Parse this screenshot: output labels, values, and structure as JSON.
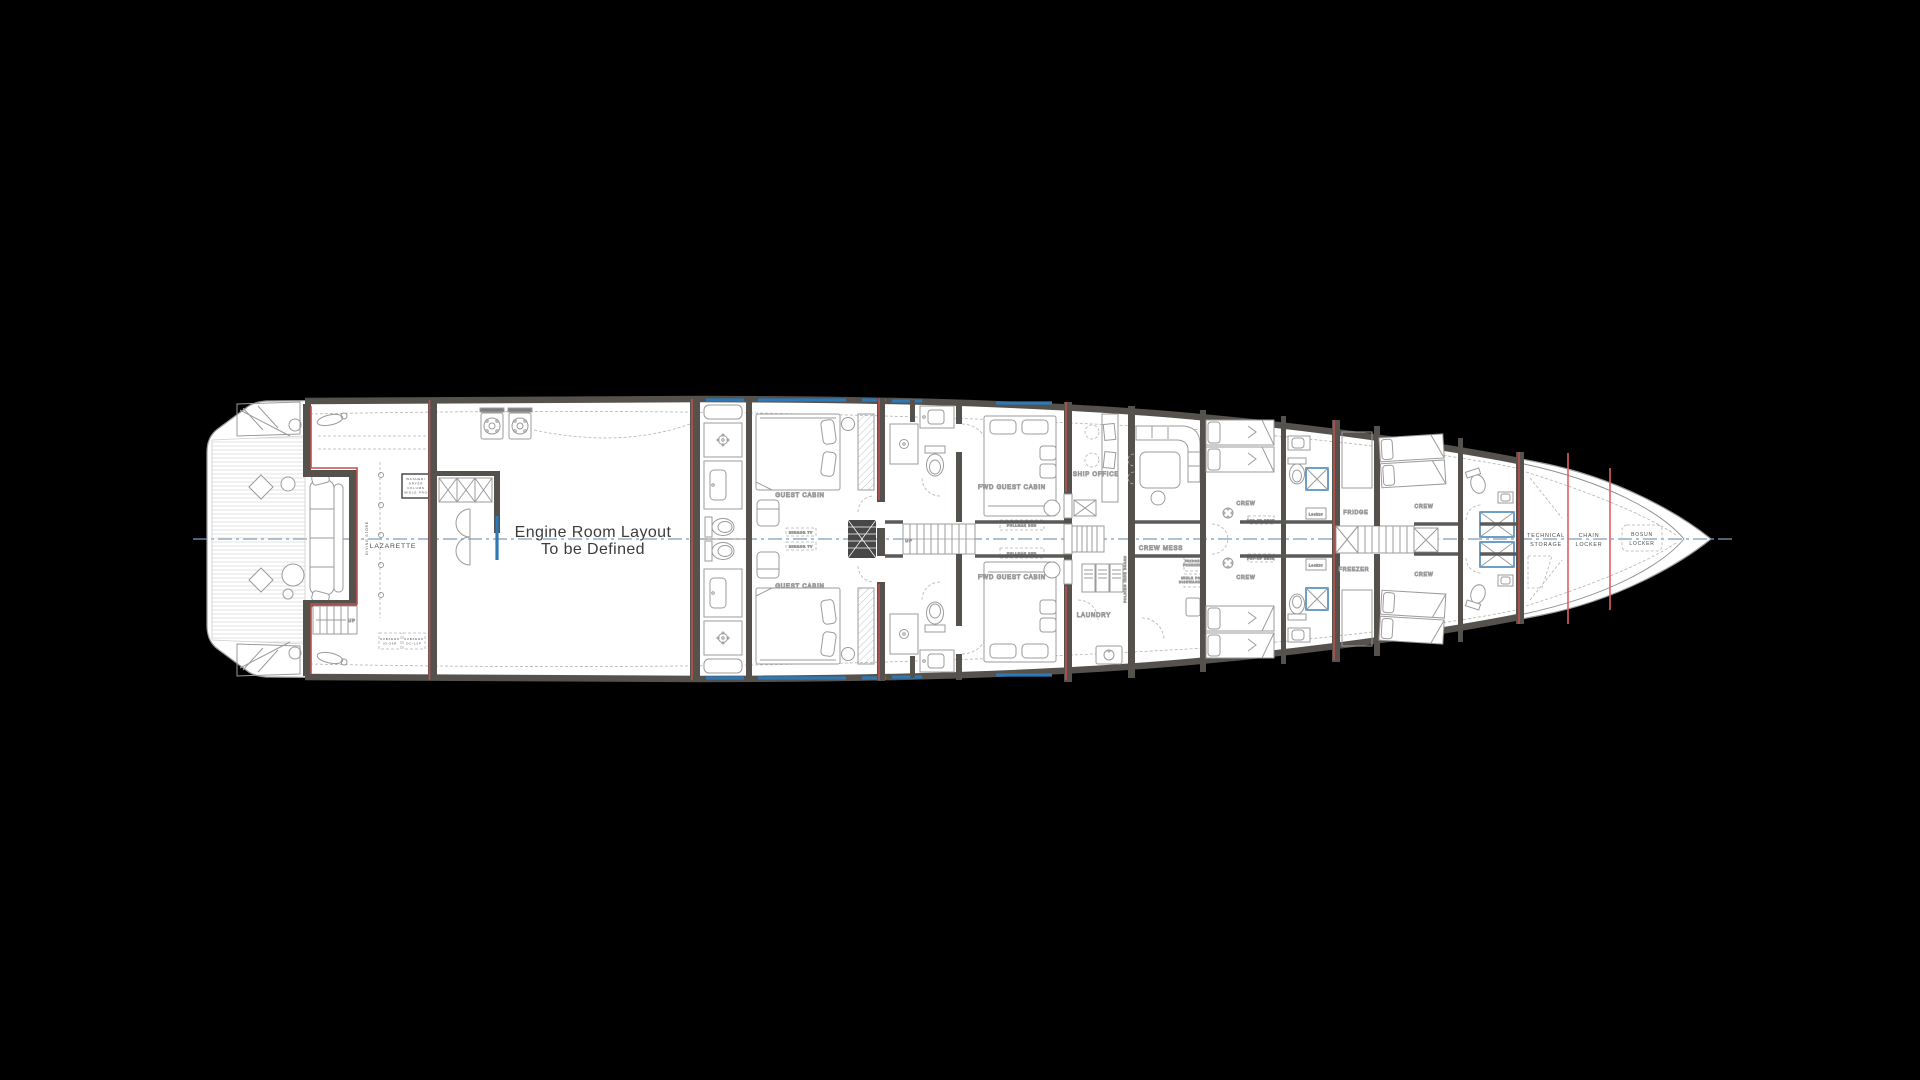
{
  "colors": {
    "background": "#000000",
    "hull_fill": "#ffffff",
    "wall": "#55514d",
    "furniture_line": "#9b9b9b",
    "text": "#4a4a4a",
    "red_accent": "#c0504d",
    "red_frame": "#e06060",
    "blue_accent": "#2e78b5",
    "centerline": "#7f9db9",
    "dash_line": "#b3b3b3"
  },
  "rooms": {
    "lazarette": "LAZARETTE",
    "diving_store": "DIVING STORE",
    "engine_room": {
      "line1": "Engine Room Layout",
      "line2": "To be Defined"
    },
    "guest_cabin": "GUEST CABIN",
    "fwd_guest_cabin": "FWD GUEST CABIN",
    "ship_office": "SHIP OFFICE",
    "laundry": "LAUNDRY",
    "crew_mess": "CREW MESS",
    "crew": "CREW",
    "fridge": "FRIDGE",
    "freezer": "FREEZER",
    "technical_storage": {
      "line1": "TECHNICAL",
      "line2": "STORAGE"
    },
    "chain_locker": {
      "line1": "CHAIN",
      "line2": "LOCKER"
    },
    "bosun_locker": {
      "line1": "BOSUN",
      "line2": "LOCKER"
    }
  },
  "annotations": {
    "up": "UP",
    "pullman_bed": "PULLMAN BED",
    "mirror_tv": "MIRROR TV",
    "pop_up_desk": "POP-UP DESK",
    "locker": "Locker",
    "washer_dryer_column": {
      "line1": "WASHER/",
      "line2": "DRYER",
      "line3": "COLUMN",
      "line4": "MIELE PRO"
    },
    "folding_iron_board": "FOLDING IRON BOARD",
    "fridge_freezer_unit": {
      "line1": "FRIDGE",
      "line2": "FREEZER"
    },
    "dishwasher_unit": {
      "line1": "MIELE PRO",
      "line2": "DISHWASHER"
    },
    "subzero_left": {
      "line1": "SUBZERO",
      "line2": "ID-36R"
    },
    "subzero_right": {
      "line1": "SUBZERO",
      "line2": "DC-15P"
    }
  }
}
